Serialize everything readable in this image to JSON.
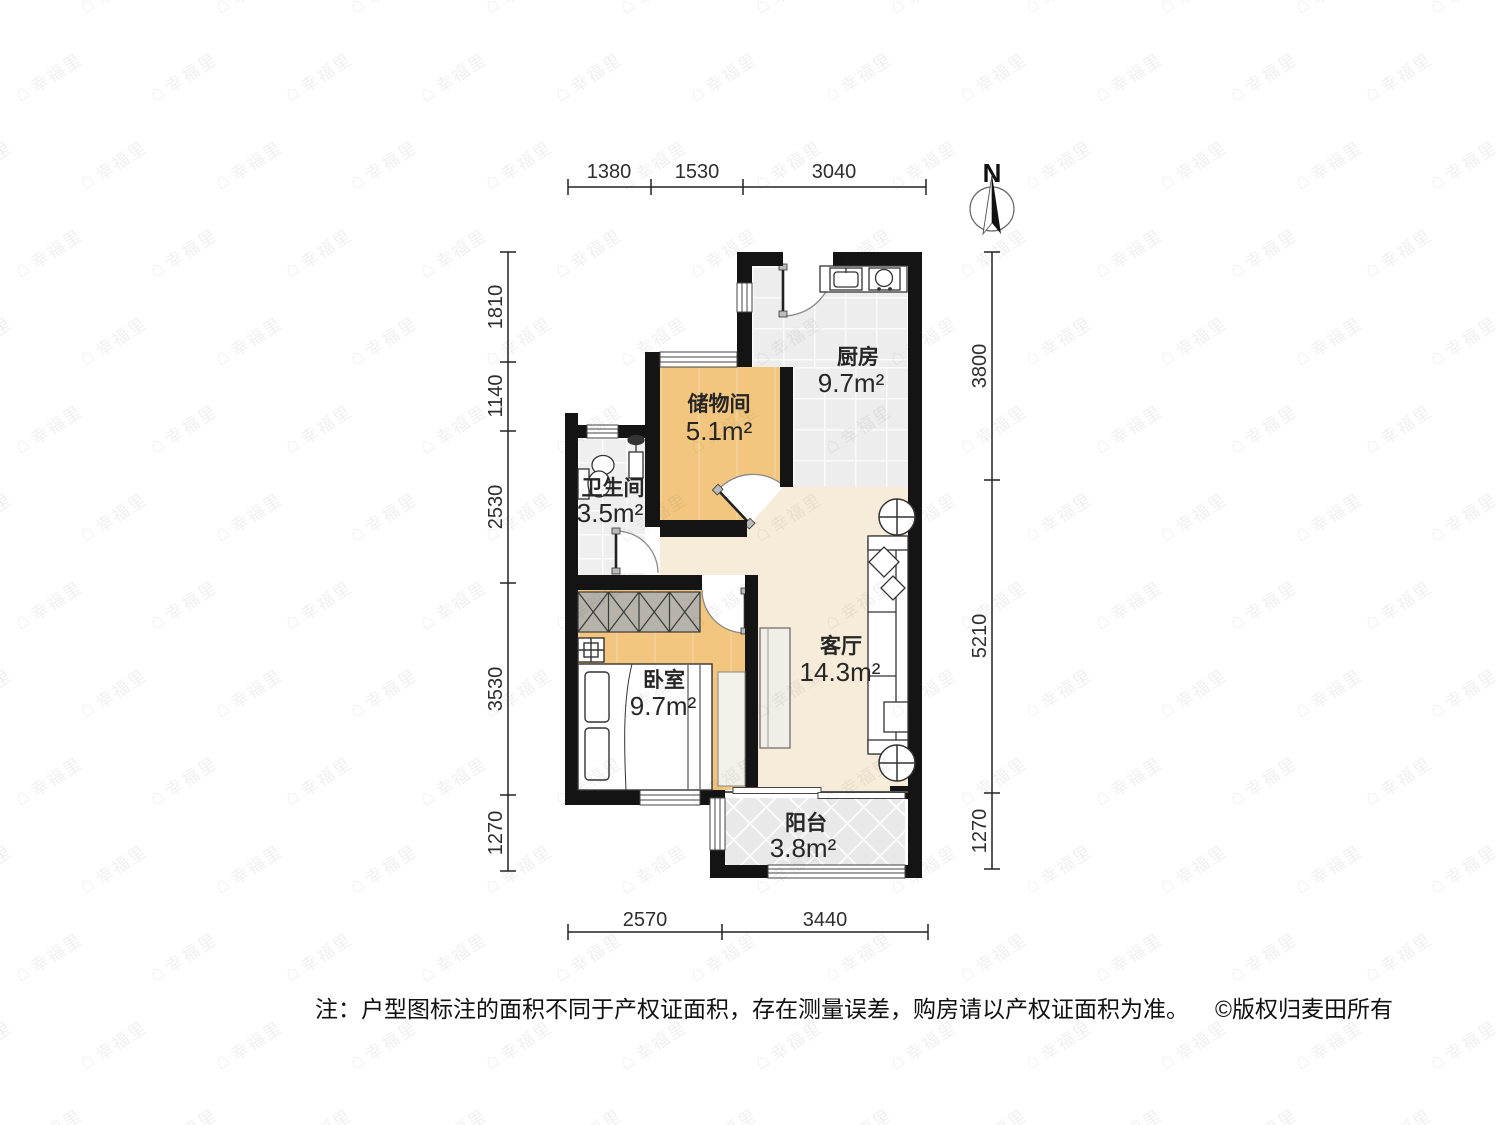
{
  "north_label": "N",
  "dims": {
    "top": [
      "1380",
      "1530",
      "3040"
    ],
    "left": [
      "1810",
      "1140",
      "2530",
      "3530",
      "1270"
    ],
    "right": [
      "3800",
      "5210",
      "1270"
    ],
    "bottom": [
      "2570",
      "3440"
    ]
  },
  "rooms": {
    "kitchen": {
      "name": "厨房",
      "area": "9.7m²"
    },
    "storage": {
      "name": "储物间",
      "area": "5.1m²"
    },
    "bathroom": {
      "name": "卫生间",
      "area": "3.5m²"
    },
    "bedroom": {
      "name": "卧室",
      "area": "9.7m²"
    },
    "living": {
      "name": "客厅",
      "area": "14.3m²"
    },
    "balcony": {
      "name": "阳台",
      "area": "3.8m²"
    }
  },
  "note": {
    "text": "注：户型图标注的面积不同于产权证面积，存在测量误差，购房请以产权证面积为准。",
    "copyright": "©版权归麦田所有"
  },
  "watermark": {
    "icon": "⌂",
    "text": "幸福里"
  },
  "colors": {
    "wall": "#141414",
    "wood": "#f2c67e",
    "beige": "#f6ecd9",
    "tile": "#ededed"
  }
}
